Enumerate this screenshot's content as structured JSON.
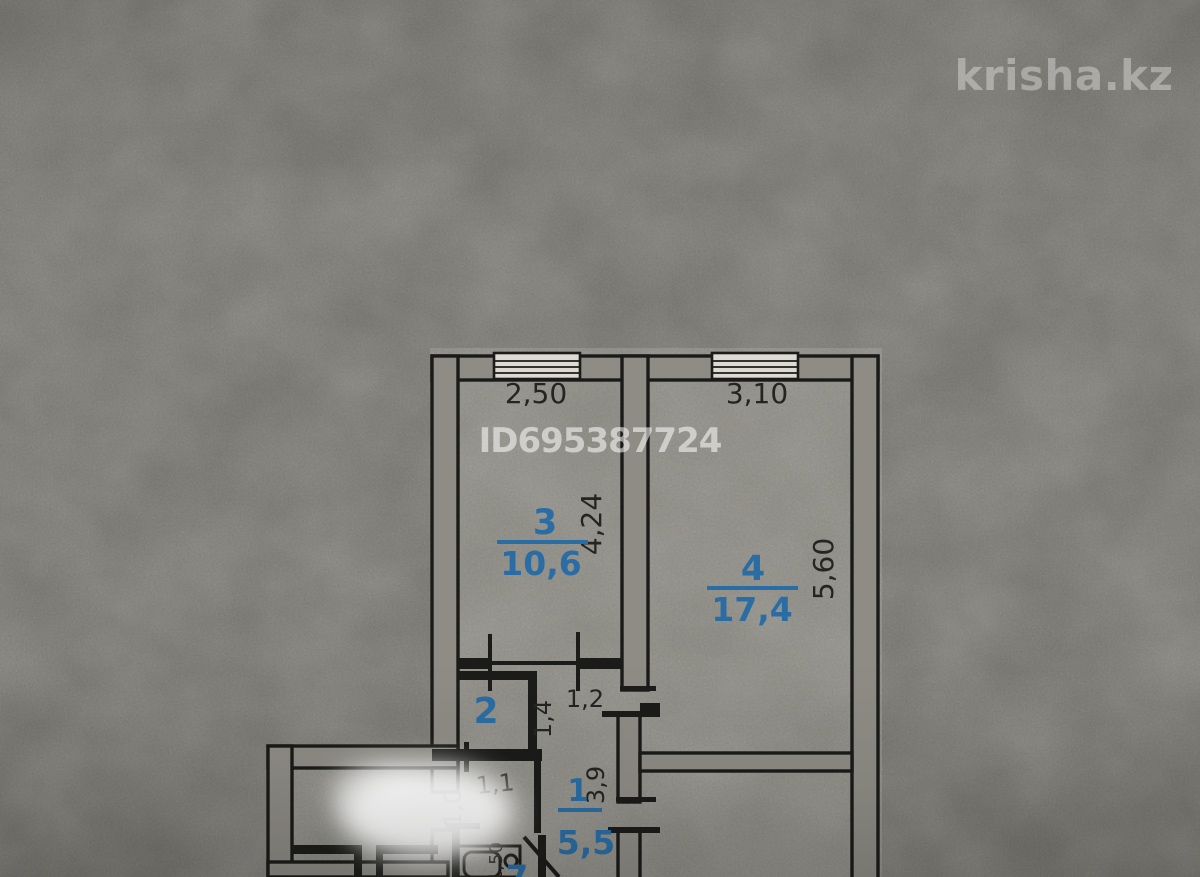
{
  "watermarks": {
    "site": "krisha.kz",
    "listing_id": "ID695387724"
  },
  "plan": {
    "rooms": {
      "room1": {
        "number": "1",
        "area": "5,5"
      },
      "room2": {
        "number": "2"
      },
      "room3": {
        "number": "3",
        "area": "10,6"
      },
      "room4": {
        "number": "4",
        "area": "17,4"
      },
      "room7": {
        "number": "7"
      }
    },
    "dimensions": {
      "room3_width": "2,50",
      "room4_width": "3,10",
      "room3_depth": "4,24",
      "room4_depth": "5,60",
      "corridor_width": "1,4",
      "door_width": "1,2",
      "hall_length": "3,9",
      "lobby_width": "1,1",
      "lobby_depth": "1,0",
      "bath_width": "1,50"
    },
    "colors": {
      "room_label": "#2a6da4",
      "dimension_text": "#242421",
      "wall": "#1b1b19"
    }
  }
}
